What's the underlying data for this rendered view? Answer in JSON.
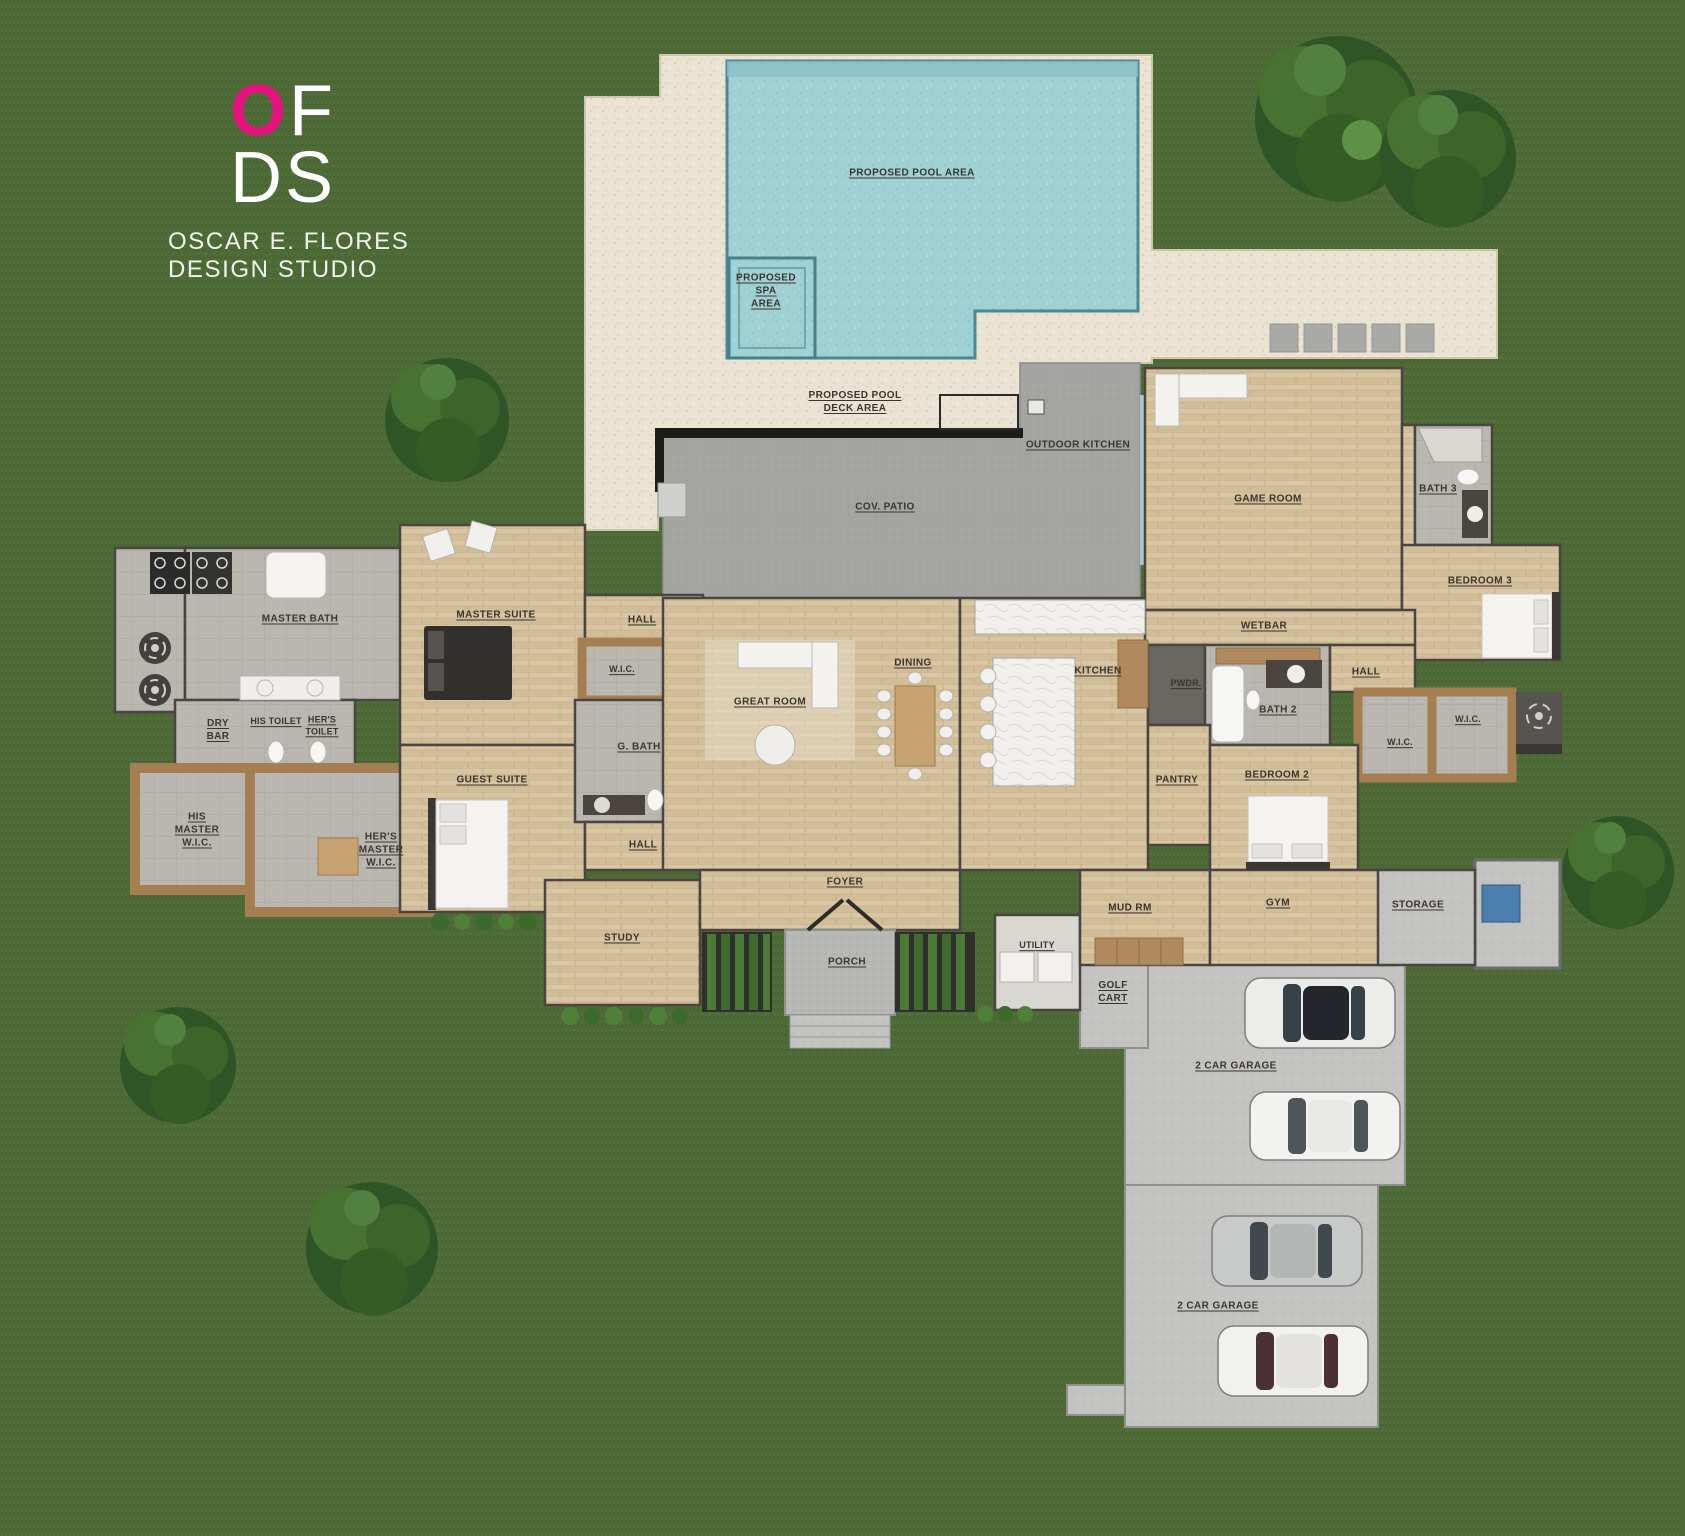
{
  "branding": {
    "logo_o": "O",
    "logo_f": "F",
    "logo_ds": "DS",
    "studio_line1": "OSCAR E. FLORES",
    "studio_line2": "DESIGN STUDIO",
    "accent_pink": "#e6127d"
  },
  "palette": {
    "grass": "#4d6a37",
    "deck": "#eae3d3",
    "water": "#9fd0d4",
    "patio": "#a4a4a2",
    "wood_floor": "#d8c6a4",
    "tile": "#bab7b1",
    "closet_wood": "#a57e52",
    "concrete": "#c3c3c1",
    "wall": "#3b3734"
  },
  "outdoor_labels": {
    "pool": "PROPOSED POOL AREA",
    "spa": "PROPOSED\nSPA\nAREA",
    "deck": "PROPOSED POOL\nDECK AREA",
    "outdoor_kitchen": "OUTDOOR KITCHEN",
    "cov_patio": "COV. PATIO",
    "golf_cart": "GOLF\nCART",
    "garage_upper": "2 CAR GARAGE",
    "garage_lower": "2 CAR GARAGE"
  },
  "rooms": {
    "master_bath": "MASTER BATH",
    "master_suite": "MASTER SUITE",
    "hall_master": "HALL",
    "wic_master": "W.I.C.",
    "g_bath": "G. BATH",
    "dry_bar": "DRY\nBAR",
    "his_toilet": "HIS TOILET",
    "hers_toilet": "HER'S\nTOILET",
    "his_master_wic": "HIS\nMASTER\nW.I.C.",
    "hers_master_wic": "HER'S\nMASTER\nW.I.C.",
    "guest_suite": "GUEST SUITE",
    "hall_guest": "HALL",
    "study": "STUDY",
    "great_room": "GREAT ROOM",
    "dining": "DINING",
    "kitchen": "KITCHEN",
    "foyer": "FOYER",
    "porch": "PORCH",
    "utility": "UTILITY",
    "mud_rm": "MUD RM",
    "gym": "GYM",
    "storage": "STORAGE",
    "pwdr": "PWDR.",
    "bath_2": "BATH 2",
    "wetbar": "WETBAR",
    "pantry": "PANTRY",
    "bedroom_2": "BEDROOM 2",
    "hall_east": "HALL",
    "wic_bedroom2": "W.I.C.",
    "wic_bedroom3": "W.I.C.",
    "game_room": "GAME ROOM",
    "bath_3": "BATH 3",
    "bedroom_3": "BEDROOM 3"
  }
}
